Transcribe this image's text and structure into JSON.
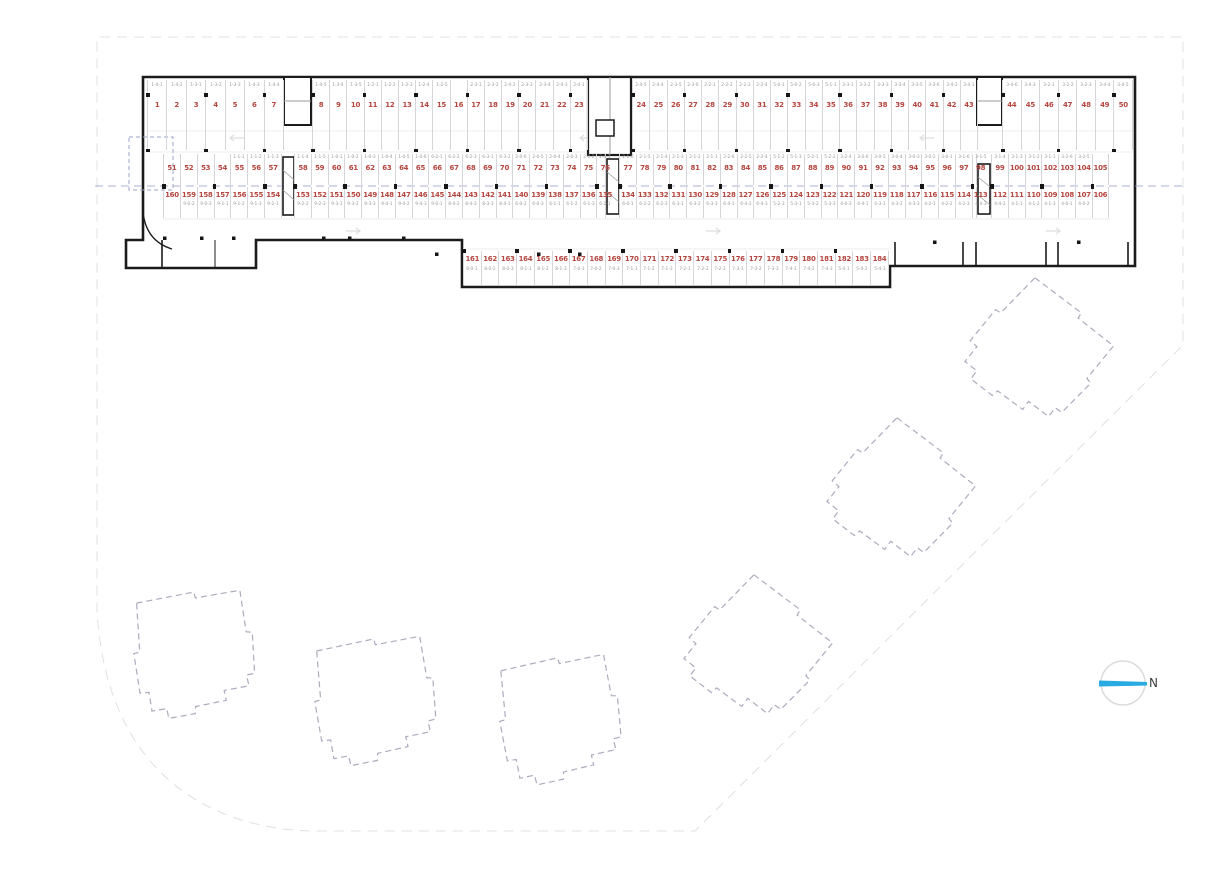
{
  "compass": {
    "label": "N"
  },
  "colors": {
    "space_number": "#b5463f",
    "unit_code": "#98989e",
    "wall": "#1b1b1b",
    "stall_line": "#d6d6da",
    "section_line": "#96a0c6",
    "footprint_dash": "#aaacbc",
    "boundary": "#e0e0e2",
    "north_arrow": "#29abe2"
  },
  "parking": {
    "rows": [
      {
        "id": "row-top",
        "code_position": "top",
        "segments": [
          [
            {
              "n": "1",
              "c": "1-4-1"
            },
            {
              "n": "2",
              "c": "1-4-2"
            },
            {
              "n": "3",
              "c": "1-3-1"
            },
            {
              "n": "4",
              "c": "1-3-2"
            },
            {
              "n": "5",
              "c": "1-3-3"
            },
            {
              "n": "6",
              "c": "1-4-3"
            },
            {
              "n": "7",
              "c": "1-4-4"
            }
          ],
          [
            {
              "n": "8",
              "c": "1-4-5"
            },
            {
              "n": "9",
              "c": "1-3-4"
            },
            {
              "n": "10",
              "c": "1-3-5"
            },
            {
              "n": "11",
              "c": "1-2-1"
            },
            {
              "n": "12",
              "c": "1-2-2"
            },
            {
              "n": "13",
              "c": "1-2-3"
            },
            {
              "n": "14",
              "c": "1-2-4"
            },
            {
              "n": "15",
              "c": "1-2-5"
            },
            {
              "n": "16",
              "c": ""
            },
            {
              "n": "17",
              "c": "2-3-1"
            },
            {
              "n": "18",
              "c": "2-3-2"
            },
            {
              "n": "19",
              "c": "2-4-2"
            },
            {
              "n": "20",
              "c": "2-3-3"
            },
            {
              "n": "21",
              "c": "2-3-4"
            },
            {
              "n": "22",
              "c": "2-4-3"
            },
            {
              "n": "23",
              "c": "2-4-1"
            }
          ],
          [
            {
              "n": "24",
              "c": "2-4-5"
            },
            {
              "n": "25",
              "c": "2-4-4"
            },
            {
              "n": "26",
              "c": "2-3-5"
            },
            {
              "n": "27",
              "c": "2-3-6"
            },
            {
              "n": "28",
              "c": "2-2-1"
            },
            {
              "n": "29",
              "c": "2-2-2"
            },
            {
              "n": "30",
              "c": "2-2-3"
            },
            {
              "n": "31",
              "c": "2-2-4"
            },
            {
              "n": "32",
              "c": "5-0-1"
            },
            {
              "n": "33",
              "c": "5-0-2"
            },
            {
              "n": "34",
              "c": "5-0-3"
            },
            {
              "n": "35",
              "c": "5-1-1"
            },
            {
              "n": "36",
              "c": "3-3-1"
            },
            {
              "n": "37",
              "c": "3-3-2"
            },
            {
              "n": "38",
              "c": "3-3-3"
            },
            {
              "n": "39",
              "c": "3-3-4"
            },
            {
              "n": "40",
              "c": "3-3-5"
            },
            {
              "n": "41",
              "c": "3-3-6"
            },
            {
              "n": "42",
              "c": "3-4-2"
            },
            {
              "n": "43",
              "c": "3-4-1"
            }
          ],
          [
            {
              "n": "44",
              "c": "3-4-6"
            },
            {
              "n": "45",
              "c": "3-4-3"
            },
            {
              "n": "46",
              "c": "3-2-1"
            },
            {
              "n": "47",
              "c": "3-2-2"
            },
            {
              "n": "48",
              "c": "3-2-3"
            },
            {
              "n": "49",
              "c": "3-4-4"
            },
            {
              "n": "50",
              "c": "3-4-5"
            }
          ]
        ]
      },
      {
        "id": "row-mid-upper",
        "code_position": "top",
        "segments": [
          [
            {
              "n": "51",
              "c": ""
            },
            {
              "n": "52",
              "c": ""
            },
            {
              "n": "53",
              "c": ""
            },
            {
              "n": "54",
              "c": ""
            },
            {
              "n": "55",
              "c": "1-1-1"
            },
            {
              "n": "56",
              "c": "1-1-2"
            },
            {
              "n": "57",
              "c": "1-1-3"
            }
          ],
          [
            {
              "n": "58",
              "c": "1-1-4"
            },
            {
              "n": "59",
              "c": "1-1-5"
            },
            {
              "n": "60",
              "c": "1-0-1"
            },
            {
              "n": "61",
              "c": "1-0-2"
            },
            {
              "n": "62",
              "c": "1-0-3"
            },
            {
              "n": "63",
              "c": "1-0-4"
            },
            {
              "n": "64",
              "c": "1-0-5"
            },
            {
              "n": "65",
              "c": "1-0-6"
            },
            {
              "n": "66",
              "c": "6-2-1"
            },
            {
              "n": "67",
              "c": "6-2-2"
            },
            {
              "n": "68",
              "c": "6-2-3"
            },
            {
              "n": "69",
              "c": "6-3-1"
            },
            {
              "n": "70",
              "c": "6-3-2"
            },
            {
              "n": "71",
              "c": "2-0-6"
            },
            {
              "n": "72",
              "c": "2-0-5"
            },
            {
              "n": "73",
              "c": "2-0-4"
            },
            {
              "n": "74",
              "c": "2-0-3"
            },
            {
              "n": "75",
              "c": "2-0-2"
            },
            {
              "n": "76",
              "c": "2-0-1"
            }
          ],
          [
            {
              "n": "77",
              "c": "2-1-6"
            },
            {
              "n": "78",
              "c": "2-1-5"
            },
            {
              "n": "79",
              "c": "2-1-4"
            },
            {
              "n": "80",
              "c": "2-1-3"
            },
            {
              "n": "81",
              "c": "2-1-2"
            },
            {
              "n": "82",
              "c": "2-1-1"
            },
            {
              "n": "83",
              "c": "2-2-6"
            },
            {
              "n": "84",
              "c": "2-2-5"
            },
            {
              "n": "85",
              "c": "2-2-4"
            },
            {
              "n": "86",
              "c": "5-1-2"
            },
            {
              "n": "87",
              "c": "5-1-3"
            },
            {
              "n": "88",
              "c": "5-2-1"
            },
            {
              "n": "89",
              "c": "5-2-2"
            },
            {
              "n": "90",
              "c": "3-2-4"
            },
            {
              "n": "91",
              "c": "3-0-6"
            },
            {
              "n": "92",
              "c": "3-0-5"
            },
            {
              "n": "93",
              "c": "3-0-4"
            },
            {
              "n": "94",
              "c": "3-0-3"
            },
            {
              "n": "95",
              "c": "3-0-2"
            },
            {
              "n": "96",
              "c": "3-0-1"
            },
            {
              "n": "97",
              "c": "3-1-6"
            },
            {
              "n": "98",
              "c": "3-1-5"
            }
          ],
          [
            {
              "n": "99",
              "c": "3-1-4"
            },
            {
              "n": "100",
              "c": "3-1-3"
            },
            {
              "n": "101",
              "c": "3-1-2"
            },
            {
              "n": "102",
              "c": "3-1-1"
            },
            {
              "n": "103",
              "c": "3-2-6"
            },
            {
              "n": "104",
              "c": "3-2-5"
            },
            {
              "n": "105",
              "c": ""
            }
          ]
        ]
      },
      {
        "id": "row-mid-lower",
        "code_position": "bottom",
        "segments": [
          [
            {
              "n": "160",
              "c": ""
            },
            {
              "n": "159",
              "c": "9-0-2"
            },
            {
              "n": "158",
              "c": "9-0-3"
            },
            {
              "n": "157",
              "c": "9-1-1"
            },
            {
              "n": "156",
              "c": "9-1-2"
            },
            {
              "n": "155",
              "c": "9-1-3"
            },
            {
              "n": "154",
              "c": "9-2-1"
            }
          ],
          [
            {
              "n": "153",
              "c": "9-2-2"
            },
            {
              "n": "152",
              "c": "9-2-3"
            },
            {
              "n": "151",
              "c": "9-3-1"
            },
            {
              "n": "150",
              "c": "9-3-2"
            },
            {
              "n": "149",
              "c": "9-3-3"
            },
            {
              "n": "148",
              "c": "9-4-1"
            },
            {
              "n": "147",
              "c": "9-4-2"
            },
            {
              "n": "146",
              "c": "9-4-3"
            },
            {
              "n": "145",
              "c": "9-0-1"
            },
            {
              "n": "144",
              "c": "8-4-2"
            },
            {
              "n": "143",
              "c": "8-4-3"
            },
            {
              "n": "142",
              "c": "8-3-3"
            },
            {
              "n": "141",
              "c": "8-4-1"
            },
            {
              "n": "140",
              "c": "6-0-2"
            },
            {
              "n": "139",
              "c": "6-0-3"
            },
            {
              "n": "138",
              "c": "6-1-1"
            },
            {
              "n": "137",
              "c": "6-1-2"
            },
            {
              "n": "136",
              "c": "6-1-3"
            },
            {
              "n": "135",
              "c": "6-2-1"
            }
          ],
          [
            {
              "n": "134",
              "c": "6-0-1"
            },
            {
              "n": "133",
              "c": "6-2-2"
            },
            {
              "n": "132",
              "c": "6-2-3"
            },
            {
              "n": "131",
              "c": "6-3-1"
            },
            {
              "n": "130",
              "c": "6-3-2"
            },
            {
              "n": "129",
              "c": "6-3-3"
            },
            {
              "n": "128",
              "c": "6-4-1"
            },
            {
              "n": "127",
              "c": "6-4-2"
            },
            {
              "n": "126",
              "c": "6-4-3"
            },
            {
              "n": "125",
              "c": "5-2-3"
            },
            {
              "n": "124",
              "c": "5-3-1"
            },
            {
              "n": "123",
              "c": "5-3-2"
            },
            {
              "n": "122",
              "c": "5-3-3"
            },
            {
              "n": "121",
              "c": "4-0-3"
            },
            {
              "n": "120",
              "c": "4-4-1"
            },
            {
              "n": "119",
              "c": "4-3-1"
            },
            {
              "n": "118",
              "c": "4-3-2"
            },
            {
              "n": "117",
              "c": "4-3-3"
            },
            {
              "n": "116",
              "c": "4-2-1"
            },
            {
              "n": "115",
              "c": "4-2-2"
            },
            {
              "n": "114",
              "c": "4-2-3"
            },
            {
              "n": "113",
              "c": "4-4-3"
            }
          ],
          [
            {
              "n": "112",
              "c": "4-4-2"
            },
            {
              "n": "111",
              "c": "4-1-1"
            },
            {
              "n": "110",
              "c": "4-1-2"
            },
            {
              "n": "109",
              "c": "4-1-3"
            },
            {
              "n": "108",
              "c": "4-0-1"
            },
            {
              "n": "107",
              "c": "4-0-2"
            },
            {
              "n": "106",
              "c": ""
            }
          ]
        ]
      },
      {
        "id": "row-bottom",
        "code_position": "bottom",
        "segments": [
          [
            {
              "n": "161",
              "c": "8-0-1"
            },
            {
              "n": "162",
              "c": "8-0-2"
            },
            {
              "n": "163",
              "c": "8-0-3"
            },
            {
              "n": "164",
              "c": "8-1-1"
            },
            {
              "n": "165",
              "c": "8-1-2"
            },
            {
              "n": "166",
              "c": "8-1-3"
            },
            {
              "n": "167",
              "c": "7-0-1"
            },
            {
              "n": "168",
              "c": "7-0-2"
            },
            {
              "n": "169",
              "c": "7-0-3"
            },
            {
              "n": "170",
              "c": "7-1-1"
            },
            {
              "n": "171",
              "c": "7-1-2"
            },
            {
              "n": "172",
              "c": "7-1-3"
            },
            {
              "n": "173",
              "c": "7-2-1"
            },
            {
              "n": "174",
              "c": "7-2-2"
            },
            {
              "n": "175",
              "c": "7-2-3"
            },
            {
              "n": "176",
              "c": "7-3-1"
            },
            {
              "n": "177",
              "c": "7-3-2"
            },
            {
              "n": "178",
              "c": "7-3-3"
            },
            {
              "n": "179",
              "c": "7-4-1"
            },
            {
              "n": "180",
              "c": "7-4-2"
            },
            {
              "n": "181",
              "c": "7-4-3"
            },
            {
              "n": "182",
              "c": "5-4-1"
            },
            {
              "n": "183",
              "c": "5-4-2"
            },
            {
              "n": "184",
              "c": "5-4-3"
            }
          ]
        ]
      }
    ]
  }
}
